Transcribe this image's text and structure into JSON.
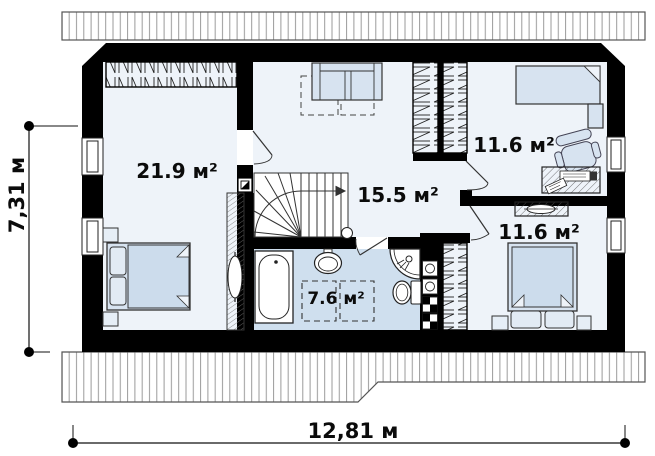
{
  "plan": {
    "title": "attic floor plan",
    "rooms": [
      {
        "name": "bedroom-left",
        "area": "21.9 м²"
      },
      {
        "name": "hall",
        "area": "15.5 м²"
      },
      {
        "name": "bedroom-top-right",
        "area": "11.6 м²"
      },
      {
        "name": "bedroom-bottom-right",
        "area": "11.6 м²"
      },
      {
        "name": "bathroom",
        "area": "7.6 м²"
      }
    ],
    "dimensions": {
      "height": "7,31 м",
      "width": "12,81 м"
    },
    "colors": {
      "wall": "#000000",
      "floor": "#eef3f9",
      "bathroom_floor": "#cfdfee",
      "furniture": "#d7e3f0",
      "roof_hatch_line": "#9a9a9a"
    }
  }
}
